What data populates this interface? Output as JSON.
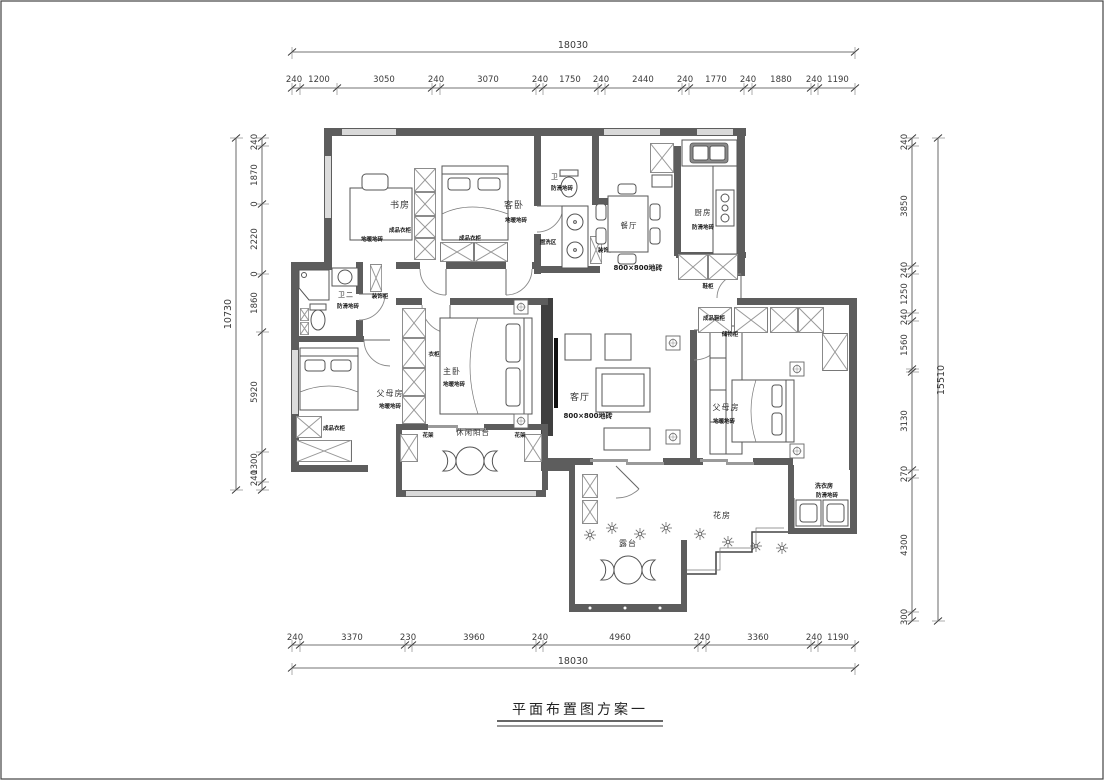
{
  "title": {
    "text": "平面布置图方案一"
  },
  "dimensions": {
    "top": {
      "total": "18030",
      "segments": [
        "240",
        "1200",
        "3050",
        "240",
        "3070",
        "240",
        "1750",
        "240",
        "2440",
        "240",
        "1770",
        "240",
        "1880",
        "240",
        "1190"
      ]
    },
    "bottom": {
      "total": "18030",
      "segments": [
        "240",
        "3370",
        "230",
        "3960",
        "240",
        "4960",
        "240",
        "3360",
        "240",
        "1190"
      ]
    },
    "left": {
      "total": "10730",
      "segments": [
        "240",
        "1870",
        "0",
        "2220",
        "0",
        "1860",
        "5920",
        "1300",
        "240"
      ]
    },
    "right": {
      "total": "15510",
      "segments": [
        "240",
        "3850",
        "240",
        "1250",
        "240",
        "1560",
        "3130",
        "270",
        "4300",
        "300"
      ]
    }
  },
  "rooms": {
    "study": {
      "name": "书房",
      "finish": "地暖地砖"
    },
    "guest_bedroom": {
      "name": "客卧",
      "finish": "地暖地砖"
    },
    "bath1": {
      "name": "卫一",
      "finish": "防滑地砖"
    },
    "wash_area": {
      "name": "盥洗区"
    },
    "dining": {
      "name": "餐厅",
      "finish": "800×800地砖"
    },
    "kitchen": {
      "name": "厨房",
      "finish": "防滑地砖"
    },
    "bath2": {
      "name": "卫二",
      "finish": "防滑地砖"
    },
    "parents_left": {
      "name": "父母房",
      "finish": "地暖地砖"
    },
    "master": {
      "name": "主卧",
      "finish": "地暖地砖"
    },
    "balcony": {
      "name": "休闲阳台"
    },
    "living": {
      "name": "客厅",
      "finish": "800×800地砖"
    },
    "parents_right": {
      "name": "父母房",
      "finish": "地暖地砖"
    },
    "flower_room": {
      "name": "花房"
    },
    "terrace": {
      "name": "露台"
    },
    "laundry": {
      "name": "洗衣房",
      "finish": "防滑地砖"
    }
  },
  "cabinets": {
    "wardrobe_study": "成品衣柜",
    "wardrobe_guest": "成品衣柜",
    "wardrobe_parents": "成品衣柜",
    "wardrobe_master": "衣柜",
    "shoe_cabinet": "鞋柜",
    "shoe_cabinet_entry": "成品鞋柜",
    "storage_cabinet": "储物柜",
    "deco_cabinet_hall": "装饰柜",
    "deco_cabinet_bath2": "装饰柜",
    "flower_stand_left": "花架",
    "flower_stand_right": "花架"
  }
}
